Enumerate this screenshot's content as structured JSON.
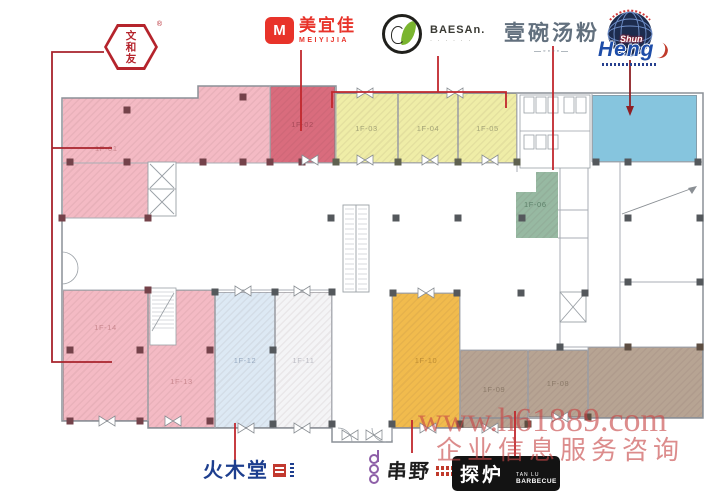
{
  "watermark": {
    "url": "www.h61889.com",
    "caption": "企业信息服务咨询"
  },
  "brands": {
    "wenheyou": {
      "name": "文和友",
      "reg": "®"
    },
    "meiyijia": {
      "icon_letter": "M",
      "chinese": "美宜佳",
      "latin": "MEIYIJIA"
    },
    "baesan": {
      "latin": "BAESAn.",
      "tagline": "· · · · · ·"
    },
    "yiwantangfen": {
      "name": "壹碗汤粉",
      "decor": "—◦◦◦◦—"
    },
    "shunheng": {
      "line1": "Shun",
      "line2": "Heng"
    },
    "huomutang": {
      "name": "火木堂"
    },
    "chuanye": {
      "name": "串野"
    },
    "tanlu": {
      "chinese": "探炉",
      "latin_top": "TAN LU",
      "latin_bottom": "BARBECUE"
    }
  },
  "plan": {
    "stair_label": "20m²",
    "connector_color": "#c1272d",
    "units": [
      {
        "label": "1F-01",
        "color": "#f4bac4",
        "label_color": "#c9888f"
      },
      {
        "label": "1F-02",
        "color": "#d96c7d",
        "label_color": "#a84b59"
      },
      {
        "label": "1F-03",
        "color": "#efeda7",
        "label_color": "#a3a377"
      },
      {
        "label": "1F-04",
        "color": "#efeda7",
        "label_color": "#a3a377"
      },
      {
        "label": "1F-05",
        "color": "#efeda7",
        "label_color": "#a3a377"
      },
      {
        "label": "1F-06",
        "color": "#97b9a2",
        "label_color": "#5d8069"
      },
      {
        "label": "1F-08",
        "color": "#b7a493",
        "label_color": "#8b7a69"
      },
      {
        "label": "1F-09",
        "color": "#b7a493",
        "label_color": "#8b7a69"
      },
      {
        "label": "1F-10",
        "color": "#f1bb4d",
        "label_color": "#bd8c33"
      },
      {
        "label": "1F-11",
        "color": "#f4f4f6",
        "label_color": "#bcbcc4"
      },
      {
        "label": "1F-12",
        "color": "#dde9f4",
        "label_color": "#97a9bf"
      },
      {
        "label": "1F-13",
        "color": "#f4bac4",
        "label_color": "#c9888f"
      },
      {
        "label": "1F-14",
        "color": "#f4bac4",
        "label_color": "#c9888f"
      },
      {
        "label": "",
        "color": "#86c5de",
        "label_color": "#ffffff"
      },
      {
        "label": "",
        "color": "#b7a493",
        "label_color": "#8b7a69"
      }
    ]
  }
}
